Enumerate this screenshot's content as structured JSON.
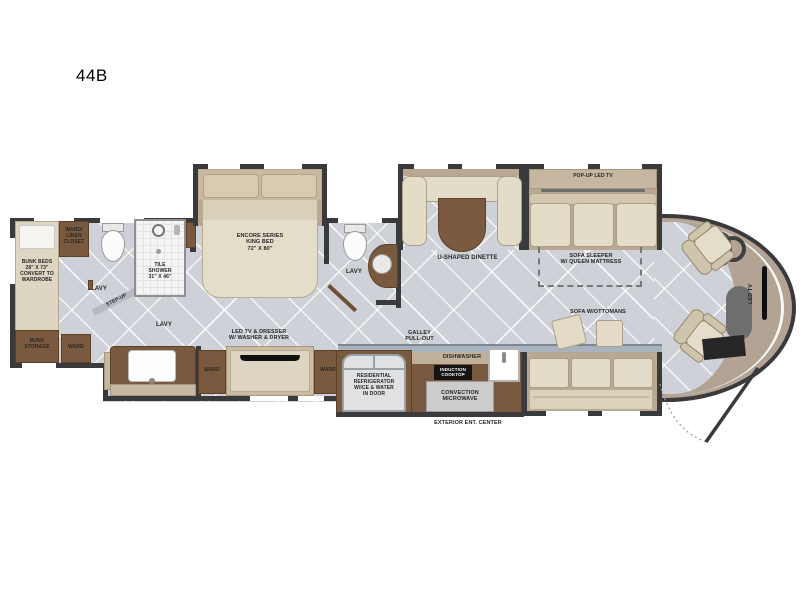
{
  "title": "44B",
  "colors": {
    "wall": "#3a3a3c",
    "floor": "#ced1d7",
    "cabinet_brown": "#7a5a3e",
    "slide_trim_tan": "#b9a992",
    "cushion_cream": "#e3dcc9",
    "counter_strip": "#a9b3bf",
    "front_cap_tan": "#b2a394",
    "appliance_black": "#151515"
  },
  "labels": {
    "bunk_beds": "BUNK BEDS\n28\" X 73\"\nCONVERT TO\nWARDROBE",
    "ward_linen_closet": "WARD/\nLINEN\nCLOSET",
    "bunk_storage": "BUNK\nSTORAGE",
    "ward_rear": "WARD",
    "lavy_rear": "LAVY",
    "step_up": "STEP-UP",
    "tile_shower": "TILE\nSHOWER\n31\" X 46\"",
    "lavy_master": "LAVY",
    "king_bed": "ENCORE SERIES\nKING BED\n72\"  X  80\"",
    "tv_dresser": "LED TV & DRESSER\nW/ WASHER & DRYER",
    "ward_left": "WARD",
    "ward_right": "WARD",
    "lavy_mid": "LAVY",
    "u_dinette": "U-SHAPED DINETTE",
    "galley_pullout": "GALLEY\nPULL-OUT",
    "dishwasher": "DISHWASHER",
    "induction_cooktop": "INDUCTION\nCOOKTOP",
    "refrigerator": "RESIDENTIAL\nREFRIGERATOR\nW/ICE & WATER\nIN DOOR",
    "convection_microwave": "CONVECTION\nMICROWAVE",
    "exterior_ent_center": "EXTERIOR ENT. CENTER",
    "popup_led_tv": "POP-UP LED TV",
    "sofa_sleeper": "SOFA SLEEPER\nW/ QUEEN MATTRESS",
    "sofa_ottomans": "SOFA W/OTTOMANS",
    "led_tv_front": "LED TV"
  }
}
